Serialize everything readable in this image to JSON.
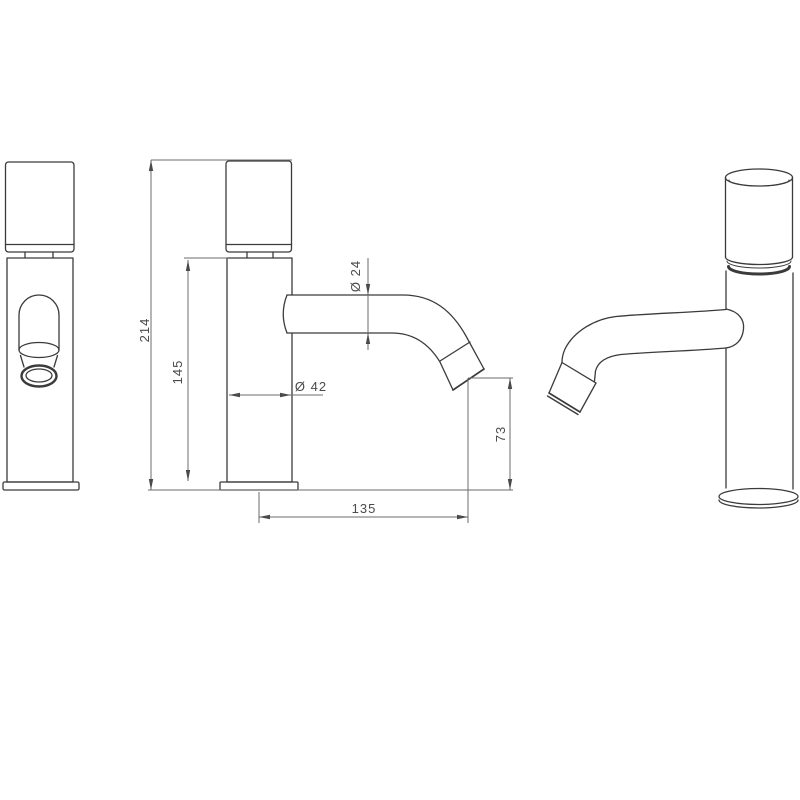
{
  "drawing": {
    "dimensions": {
      "overall_height": "214",
      "body_height": "145",
      "body_diameter": "Ø 42",
      "spout_diameter": "Ø 24",
      "spout_reach": "135",
      "spout_clearance": "73"
    },
    "colors": {
      "background": "#ffffff",
      "object_line": "#3b3b3b",
      "dimension_line": "#6b6b6b",
      "text": "#4a4a4a"
    }
  }
}
